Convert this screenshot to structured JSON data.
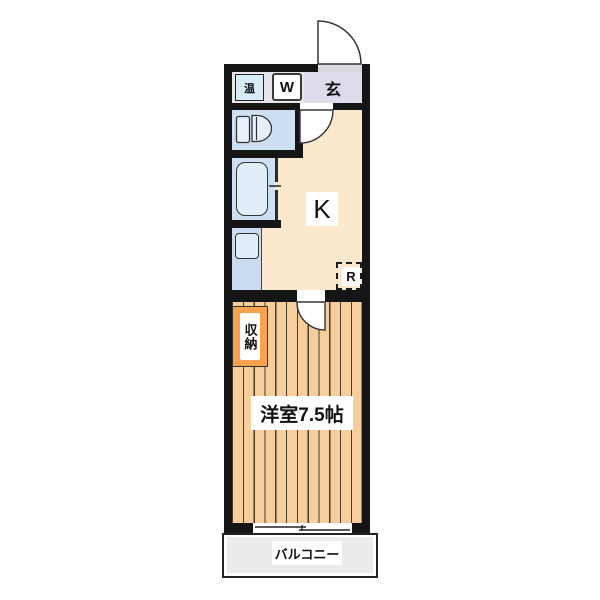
{
  "type": "apartment-floor-plan",
  "labels": {
    "water_heater": "温",
    "washing_machine": "W",
    "entrance": "玄",
    "kitchen": "K",
    "refrigerator": "R",
    "closet": "収納",
    "western_room": "洋室7.5帖",
    "balcony": "バルコニー"
  },
  "colors": {
    "wall": "#151515",
    "kitchen_floor": "#fce8cd",
    "room_floor": "#f6cd9c",
    "room_floor_stripe": "#4a3b2b",
    "closet": "#f7a24e",
    "wet_area_floor": "#cddff2",
    "fixture_fill": "#e2edfa",
    "water_heater_box": "#d8ecf8",
    "entrance_floor": "#dddcea",
    "balcony_floor": "#ebebeb"
  }
}
